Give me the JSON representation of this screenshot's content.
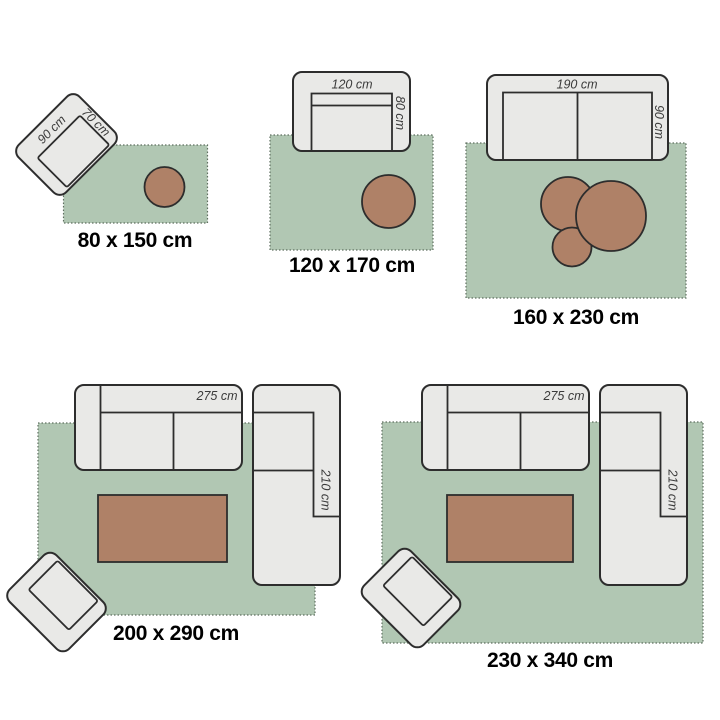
{
  "colors": {
    "background": "#ffffff",
    "rug_fill": "#b1c7b3",
    "rug_dotted_border": "#5f6f60",
    "furniture_fill": "#e9e9e7",
    "furniture_outline": "#2d2d2d",
    "table_fill": "#af8167",
    "dimension_text": "#3a3a3a",
    "size_text": "#000000"
  },
  "panels": [
    {
      "id": "80x150",
      "size_label": "80 x 150 cm",
      "armchair_width_label": "90 cm",
      "armchair_depth_label": "70 cm"
    },
    {
      "id": "120x170",
      "size_label": "120 x 170 cm",
      "sofa_width_label": "120 cm",
      "sofa_depth_label": "80 cm"
    },
    {
      "id": "160x230",
      "size_label": "160 x 230 cm",
      "sofa_width_label": "190 cm",
      "sofa_depth_label": "90 cm"
    },
    {
      "id": "200x290",
      "size_label": "200 x 290 cm",
      "sofa_width_label": "275 cm",
      "sofa_depth_label": "210 cm"
    },
    {
      "id": "230x340",
      "size_label": "230 x 340 cm",
      "sofa_width_label": "275 cm",
      "sofa_depth_label": "210 cm"
    }
  ]
}
